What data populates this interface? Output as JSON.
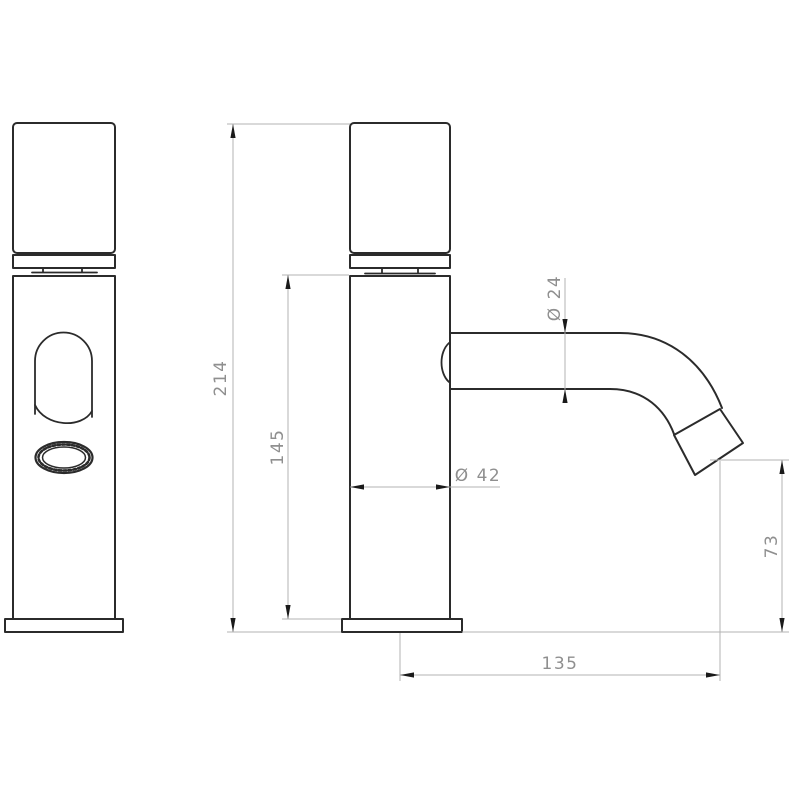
{
  "diagram": {
    "type": "technical-drawing",
    "subject": "single-lever basin faucet, front and side orthographic views",
    "dimensions": {
      "total_height": {
        "label": "214",
        "value": 214,
        "orientation": "vertical",
        "measures": "overall height from base bottom to handle top"
      },
      "body_height": {
        "label": "145",
        "value": 145,
        "orientation": "vertical",
        "measures": "body height from base flange top to body top"
      },
      "body_diameter": {
        "label": "Ø 42",
        "value": 42,
        "orientation": "horizontal",
        "measures": "body cylinder diameter"
      },
      "spout_diameter": {
        "label": "Ø 24",
        "value": 24,
        "orientation": "vertical",
        "measures": "spout tube diameter"
      },
      "outlet_height": {
        "label": "73",
        "value": 73,
        "orientation": "vertical",
        "measures": "outlet center height above base bottom"
      },
      "spout_reach": {
        "label": "135",
        "value": 135,
        "orientation": "horizontal",
        "measures": "horizontal reach from body axis to outlet center"
      }
    }
  }
}
